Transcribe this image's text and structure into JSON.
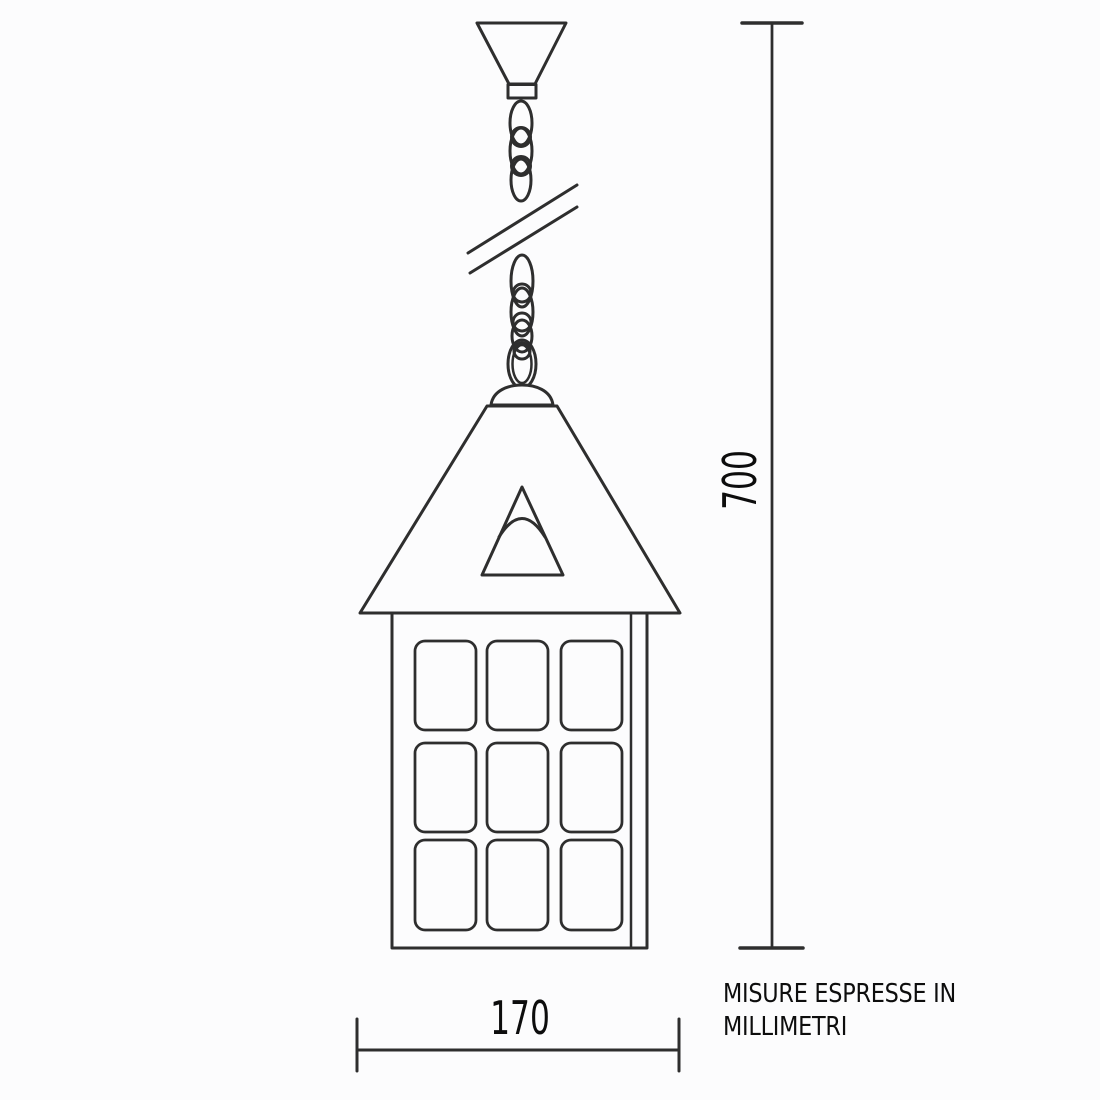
{
  "meta": {
    "css_vars": {
      "--bg": "#fcfcfd",
      "--line": "#2e2e2e",
      "--text": "#0d0d0d"
    },
    "line_color": "#2e2e2e",
    "background_color": "#fcfcfd",
    "text_color": "#0d0d0d"
  },
  "dimensions": {
    "height_label": "700",
    "width_label": "170"
  },
  "note": {
    "line1": "MISURE ESPRESSE IN",
    "line2": "MILLIMETRI"
  }
}
